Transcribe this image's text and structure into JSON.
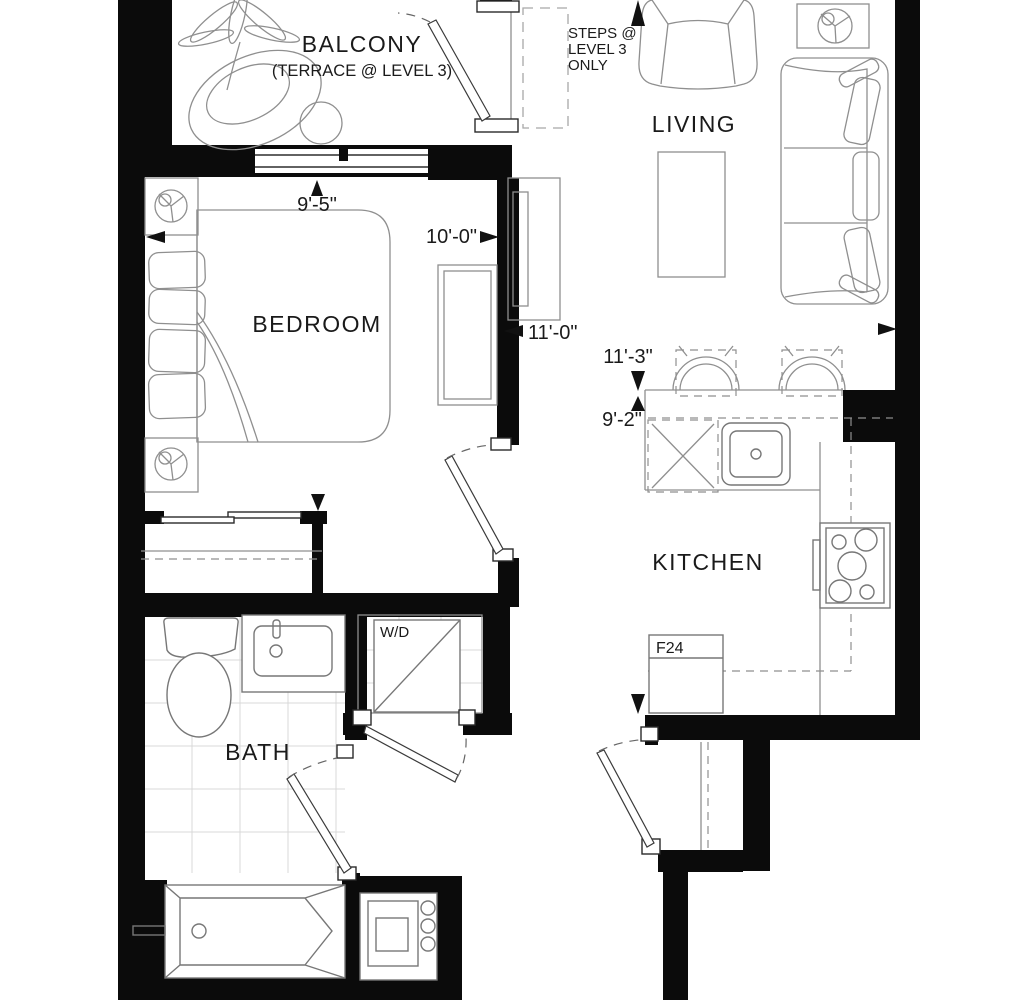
{
  "plan": {
    "type": "residential-floor-plan",
    "labels": {
      "balcony": "BALCONY",
      "balcony_sub": "(TERRACE @ LEVEL 3)",
      "steps_line1": "STEPS @",
      "steps_line2": "LEVEL 3",
      "steps_line3": "ONLY",
      "living": "LIVING",
      "bedroom": "BEDROOM",
      "kitchen": "KITCHEN",
      "bath": "BATH",
      "washer_dryer": "W/D",
      "fridge": "F24"
    },
    "dimensions": {
      "balcony_width": "9'-5\"",
      "bedroom_width": "10'-0\"",
      "living_width": "11'-0\"",
      "living_depth": "11'-3\"",
      "kitchen_depth": "9'-2\""
    },
    "colors": {
      "wall": "#0b0b0b",
      "furniture_line": "#8f8f8f",
      "fixture_line": "#777777",
      "tile_line": "#d9d9d9",
      "text": "#1a1a1a",
      "background": "#ffffff"
    },
    "symbols": [
      "plant",
      "lounge-chair",
      "round-table",
      "balcony-door",
      "bedroom-window",
      "bed",
      "pillows",
      "nightstand",
      "table-lamp",
      "dresser",
      "tv-console",
      "armchair",
      "sofa",
      "coffee-table",
      "side-table",
      "bar-stool",
      "dishwasher",
      "kitchen-sink",
      "stove",
      "fridge",
      "closet-sliding-door",
      "toilet",
      "vanity-sink",
      "bathtub",
      "washer-dryer",
      "electrical-panel",
      "entry-door",
      "bath-door",
      "bedroom-door",
      "wd-door",
      "coat-closet"
    ]
  }
}
